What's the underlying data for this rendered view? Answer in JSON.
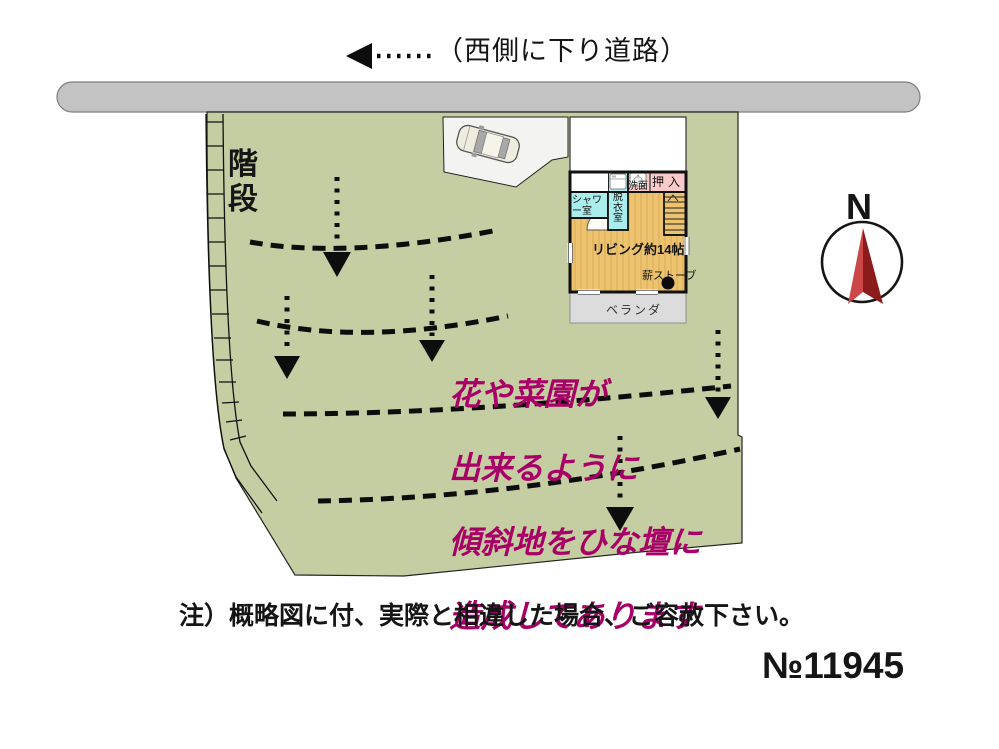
{
  "road": {
    "direction_label": "（西側に下り道路）"
  },
  "site": {
    "stairs_label": "階\n段"
  },
  "floorplan": {
    "shower_label": "シャワ\nー室",
    "dressing_label": "脱\n衣\n室",
    "washbasin_label": "洗面",
    "closet_label": "押入",
    "living_label": "リビング約14帖",
    "stove_label": "薪ストーブ",
    "veranda_label": "ベランダ"
  },
  "annotation": {
    "lines": [
      "花や菜園が",
      "出来るように",
      "傾斜地をひな壇に",
      "造成してあります"
    ],
    "color": "#a80067"
  },
  "compass": {
    "north_label": "N"
  },
  "footer": {
    "note": "注）概略図に付、実際と相違した場合、ご容赦下さい。",
    "plan_number": "№11945"
  },
  "colors": {
    "land": "#c5cda2",
    "road": "#c3c3c3",
    "living_floor": "#eec36f",
    "wet_rooms": "#aaeded",
    "closet": "#f8caca",
    "veranda": "#dcdcdc",
    "parking": "#f3f3f1",
    "annotation": "#a80067",
    "compass_needle_light": "#cc4747",
    "compass_needle_dark": "#8c1c1c"
  }
}
